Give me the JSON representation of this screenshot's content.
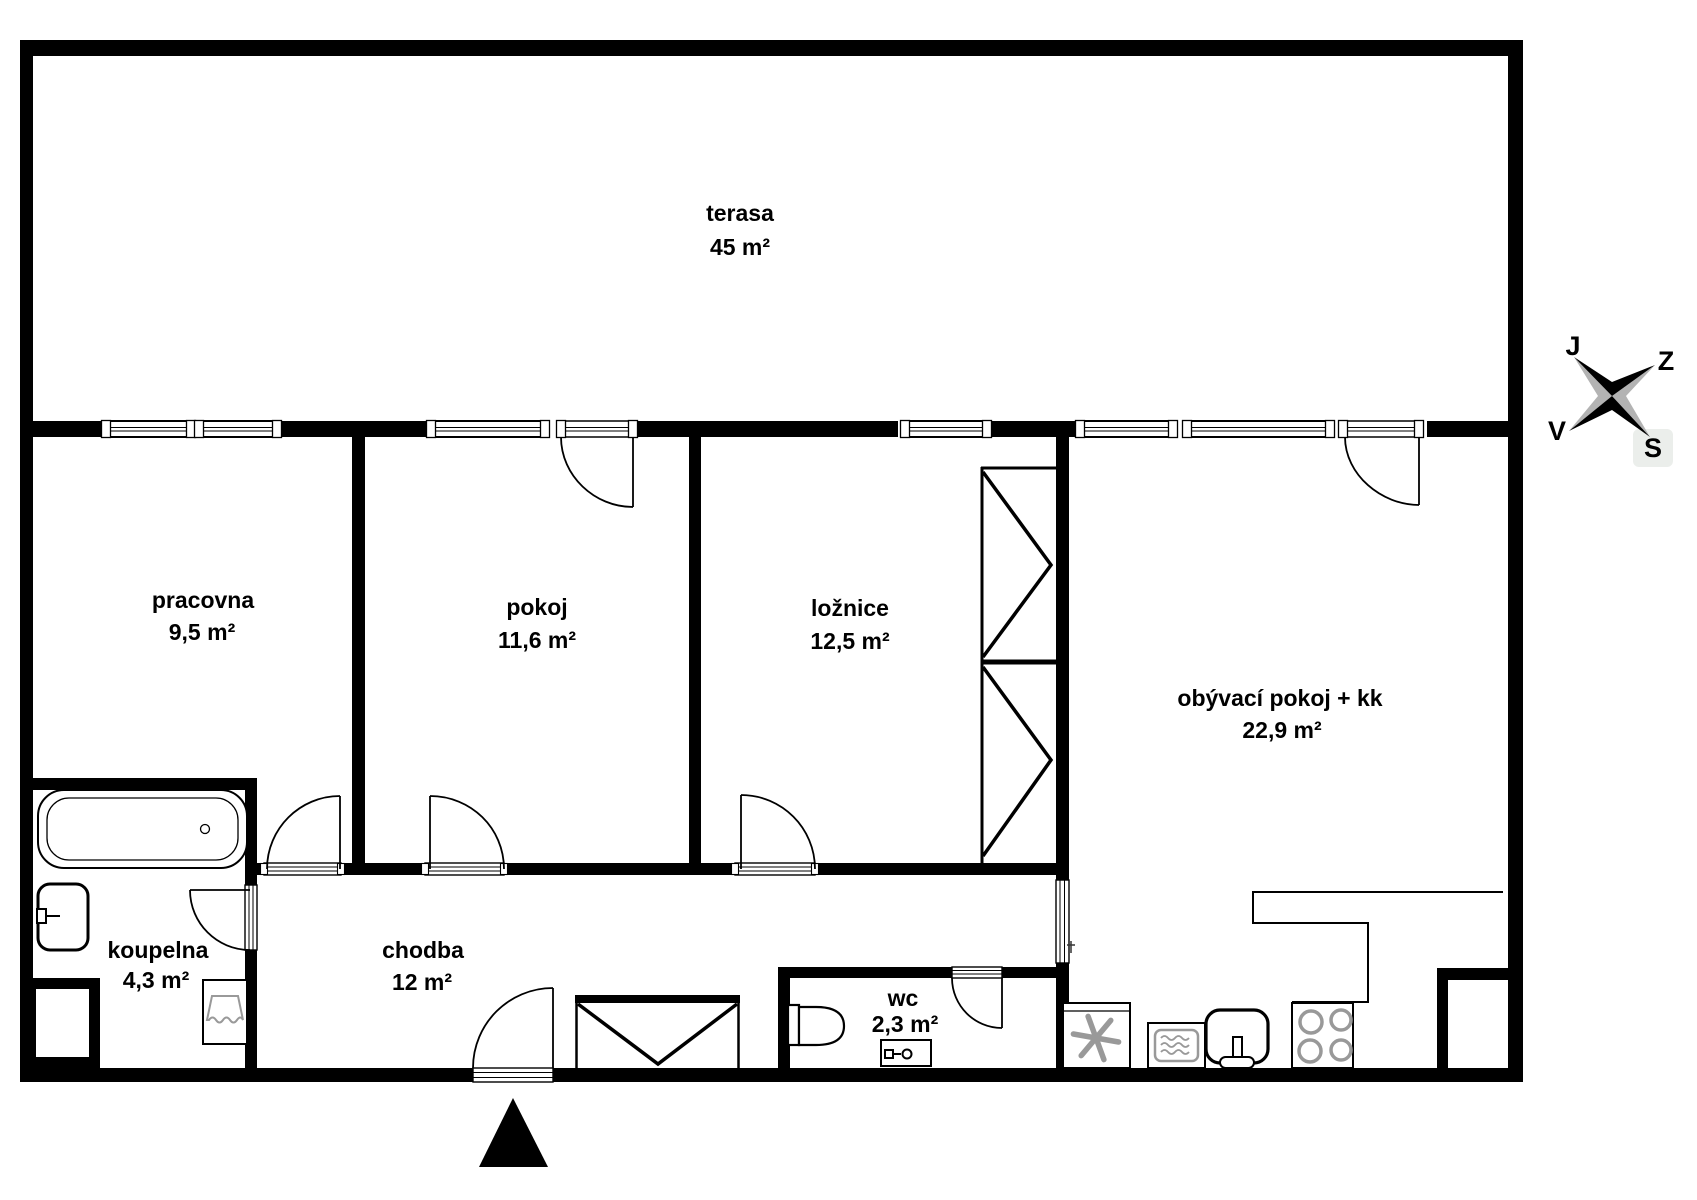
{
  "title": "apartment floor plan",
  "rooms": [
    {
      "name": "terasa",
      "area": "45 m²"
    },
    {
      "name": "pracovna",
      "area": "9,5 m²"
    },
    {
      "name": "pokoj",
      "area": "11,6 m²"
    },
    {
      "name": "ložnice",
      "area": "12,5 m²"
    },
    {
      "name": "obývací pokoj + kk",
      "area": "22,9 m²"
    },
    {
      "name": "koupelna",
      "area": "4,3 m²"
    },
    {
      "name": "chodba",
      "area": "12 m²"
    },
    {
      "name": "wc",
      "area": "2,3 m²"
    }
  ],
  "compass": {
    "labels": {
      "j": "J",
      "z": "Z",
      "v": "V",
      "s": "S"
    },
    "highlighted": "S"
  },
  "colors": {
    "wall": "#000000",
    "background": "#ffffff",
    "fixture_gray": "#999999",
    "compass_gray": "#b3b3b3",
    "highlight_box": "#ebeeeb"
  }
}
